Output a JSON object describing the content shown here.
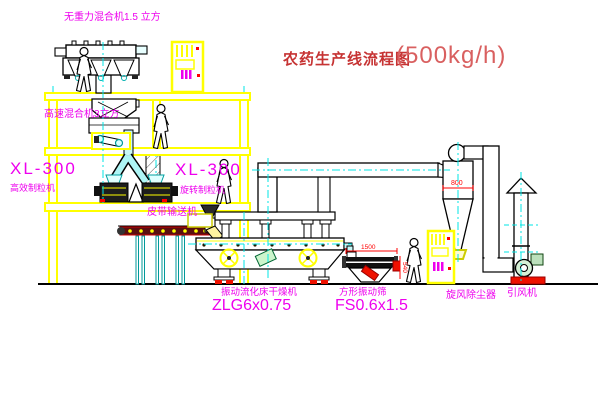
{
  "title": {
    "text": "农药生产线流程图",
    "capacity": "(500kg/h)"
  },
  "equipment_labels": {
    "no_gravity_mixer": "无重力混合机1.5 立方",
    "high_speed_mixer": "高速混合机3立方",
    "left_unit_model": "XL-300",
    "left_unit_name": "高效制粒机",
    "mid_unit_model": "XL-300",
    "mid_unit_name": "旋转制粒机",
    "belt_conveyor": "皮带输送机",
    "fluid_bed_dryer_name": "振动流化床干燥机",
    "fluid_bed_dryer_model": "ZLG6x0.75",
    "vibrating_sieve_name": "方形振动筛",
    "vibrating_sieve_model": "FS0.6x1.5",
    "cyclone_dust_collector": "旋风除尘器",
    "induced_draft_fan": "引风机"
  },
  "dimension_annotations": {
    "cyclone_width": "800",
    "sieve_length": "1500",
    "sieve_height": "540"
  },
  "colors": {
    "label_magenta": "#ee00ee",
    "title_red": "#c63333",
    "structure_yellow": "#ffff00",
    "centerline_cyan": "#00e6e6",
    "dimension_red": "#ff0000",
    "background": "#ffffff"
  }
}
